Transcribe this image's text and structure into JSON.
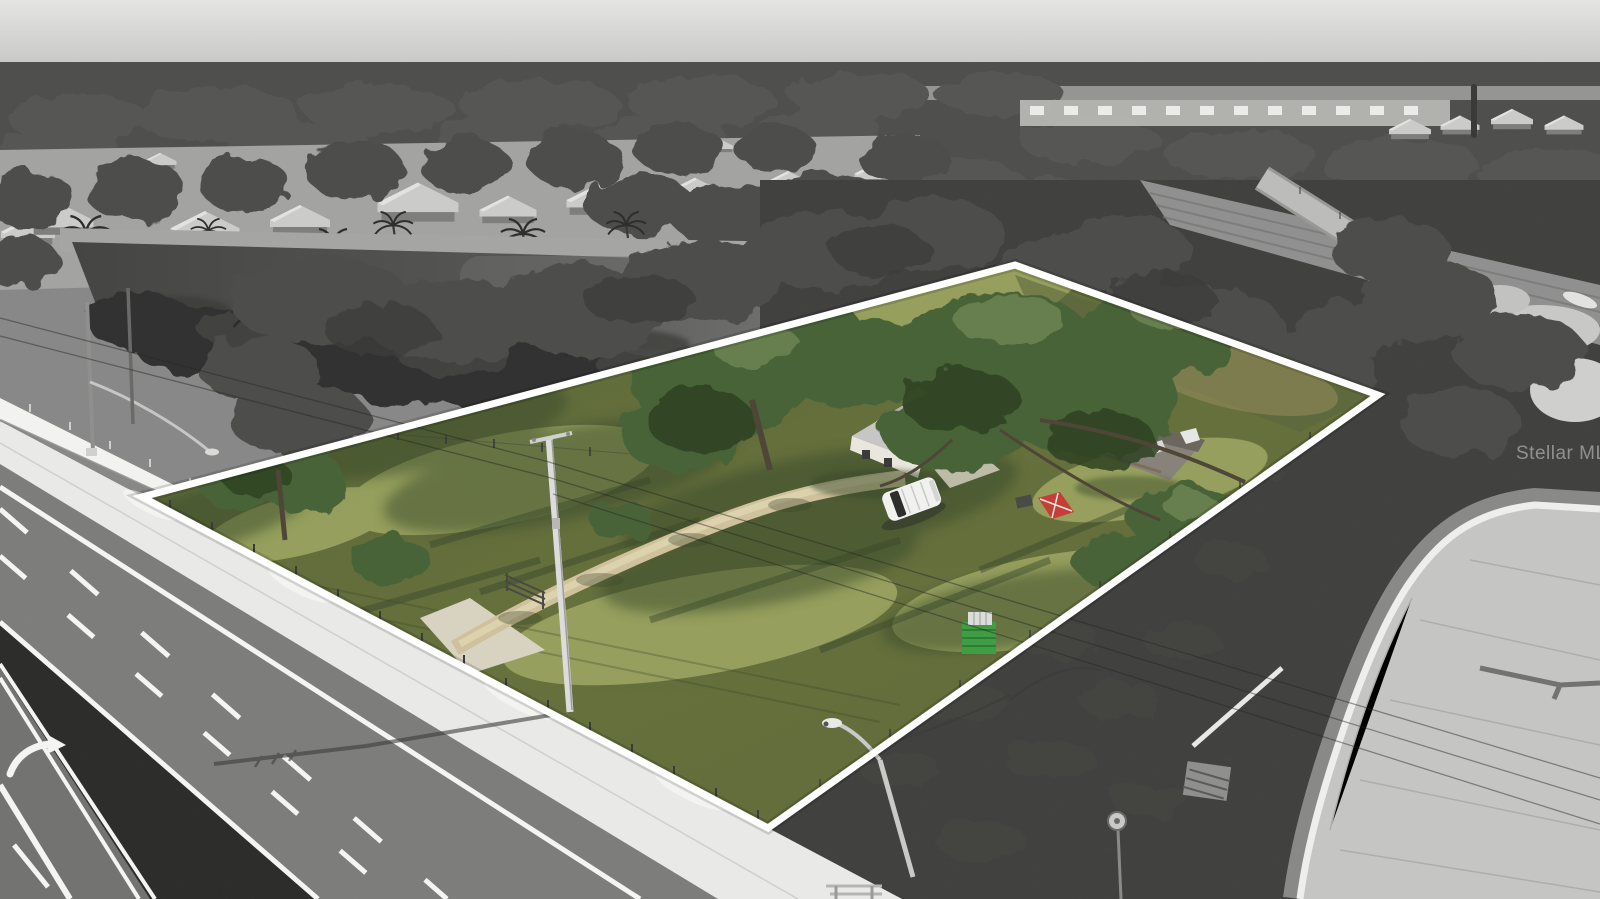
{
  "meta": {
    "kind": "aerial-drone-photograph",
    "description": "Grayscale aerial photo of a suburban highway corridor with a lakeside neighborhood; a single land parcel is shown in full color and traced with a white boundary outline.",
    "width_px": 1600,
    "height_px": 899
  },
  "watermark": {
    "text": "Stellar MLS",
    "color": "rgba(255,255,255,0.42)"
  },
  "parcel": {
    "outline_points": "142,497 1015,265 1378,395 768,828",
    "outline_color": "#ffffff",
    "outline_width": 7,
    "visible_features": [
      "lawn",
      "oak trees",
      "house with gray roof",
      "damaged shed",
      "white SUV",
      "dirt driveway",
      "farm gate",
      "red playground slide",
      "green crate",
      "utility pole",
      "fence posts"
    ]
  },
  "surroundings": {
    "visible_features": [
      "pond",
      "ranch houses",
      "palm trees",
      "divided highway with grass median",
      "left-turn arrow marking",
      "white privacy wall",
      "sidewalk",
      "street lights",
      "power lines",
      "scrub field",
      "furrowed field",
      "levee road",
      "new concrete roadway",
      "distant subdivision"
    ]
  },
  "colors": {
    "sky_top": "#e4e4e2",
    "sky_bottom": "#c3c3c1",
    "forest": "#727270",
    "water": "#454543",
    "water_light": "#7c7c7a",
    "neighborhood_ground": "#a3a3a1",
    "asphalt": "#9a9a98",
    "asphalt_near": "#8d8d8b",
    "median": "#5c5c5a",
    "lane_line": "#f4f4f2",
    "sidewalk": "#e9e9e7",
    "wall": "#f2f2f0",
    "scrub": "#6e6e6c",
    "scrub_dark": "#454543",
    "concrete": "#c5c5c3",
    "curb": "#eeeeec",
    "grass": "#84914f",
    "grass_light": "#a3ac66",
    "grass_dark": "#39482b",
    "canopy": "#4a6438",
    "canopy_dark": "#2f4222",
    "canopy_light": "#6d8452",
    "dirt": "#cfc19b",
    "house_roof": "#c6c6c4",
    "house_wall": "#e9e6dd",
    "shed_roof": "#87837b",
    "suv": "#f1f1ef",
    "slide_red": "#c63f36",
    "crate_green": "#3f9e45",
    "pole": "#dcdcda",
    "wire": "#262624",
    "outline": "#ffffff"
  }
}
